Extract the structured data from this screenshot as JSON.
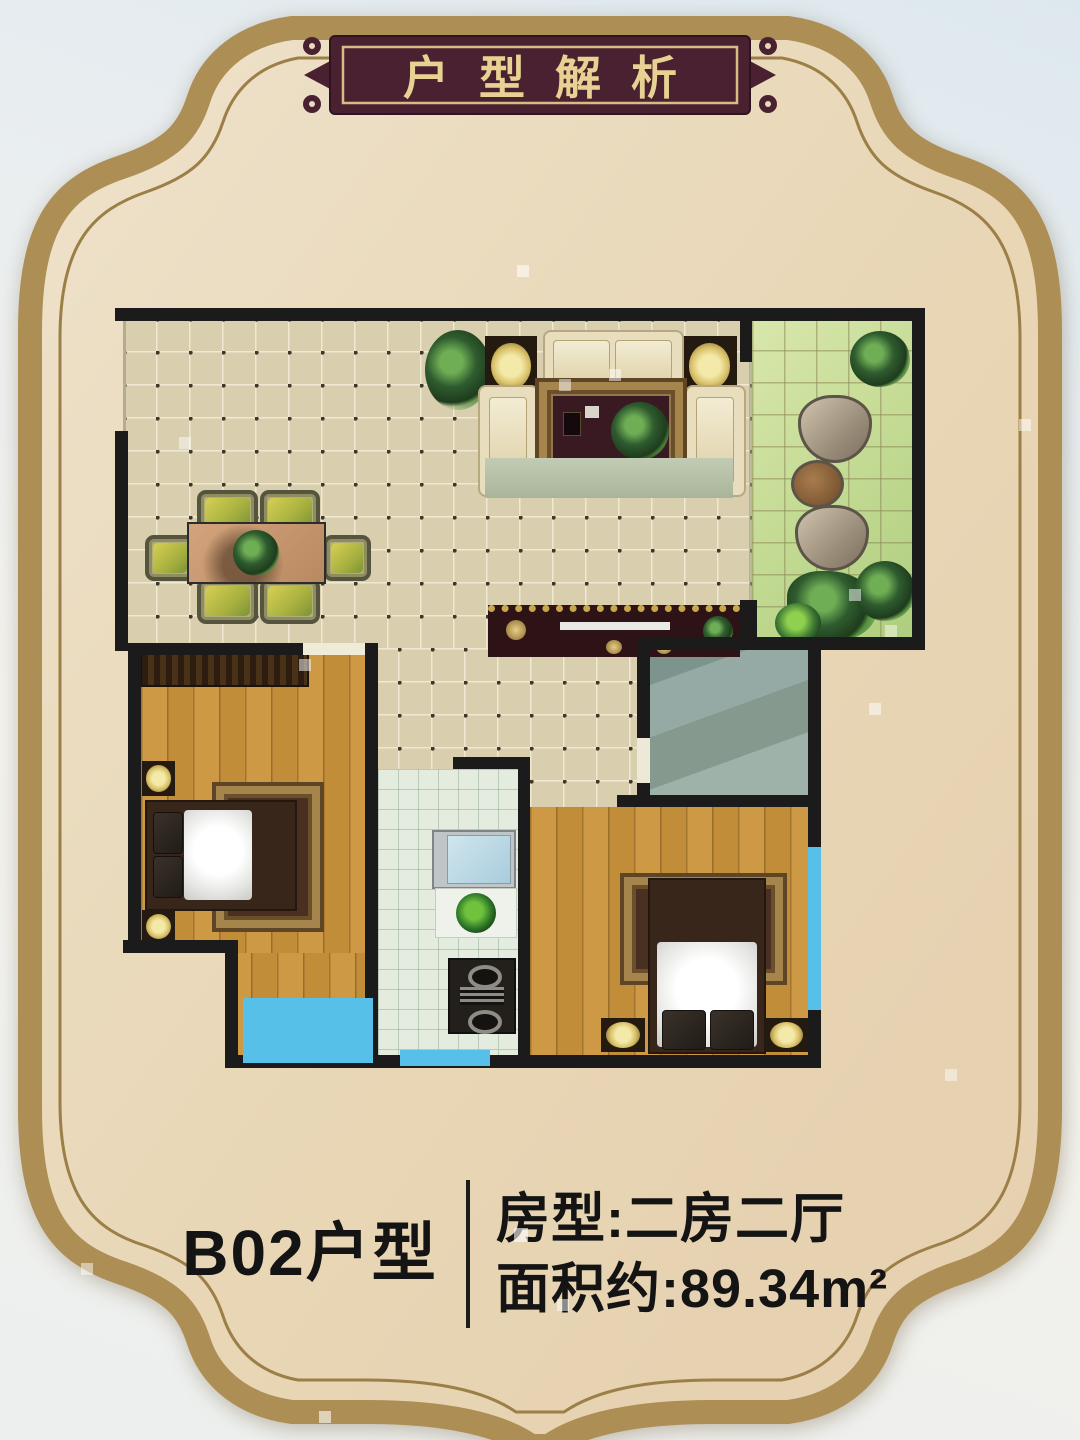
{
  "banner": {
    "title": "户型解析"
  },
  "info": {
    "unit_name": "B02户型",
    "room_type_label": "房型:二房二厅",
    "area_label": "面积约:89.34m²"
  },
  "palette": {
    "card_background": "#e9dabd",
    "photo_background": "#e8eef1",
    "frame_gold_band": "#ad8e55",
    "frame_gold_line": "#9c7f47",
    "plaque_maroon": "#4a2130",
    "plaque_text_gold": "#e7d193",
    "plaque_inner_border": "#d6bd85",
    "wall_black": "#1b1b1b",
    "tile_beige": "#d9cfae",
    "balcony_green": "#c3d893",
    "kitchen_mint": "#e4ecdf",
    "bathroom_slate": "#8fa5a0",
    "bedroom_wood": "#c6913c",
    "window_blue": "#56c0e8",
    "info_text": "#141414"
  },
  "floor_plan": {
    "rooms": [
      {
        "id": "living-dining",
        "floor": "beige-tile"
      },
      {
        "id": "hallway",
        "floor": "beige-tile"
      },
      {
        "id": "balcony-garden",
        "floor": "green-tile"
      },
      {
        "id": "bathroom",
        "floor": "slate"
      },
      {
        "id": "bedroom-1",
        "floor": "wood"
      },
      {
        "id": "bedroom-2",
        "floor": "wood"
      },
      {
        "id": "kitchen",
        "floor": "mint-tile"
      }
    ],
    "furniture": [
      "sofa-set",
      "side-lamp-tables",
      "living-rug-coffee-table",
      "tv-platform",
      "tv-console",
      "dining-table",
      "dining-chairs-x6",
      "centerpiece-plant",
      "potted-plant",
      "wardrobe",
      "double-bed-1",
      "double-bed-2",
      "wall-lamps",
      "kitchen-sink",
      "kitchen-counter-plant",
      "kitchen-stove",
      "balcony-tree",
      "stepping-stones",
      "balcony-plants",
      "windows"
    ]
  }
}
